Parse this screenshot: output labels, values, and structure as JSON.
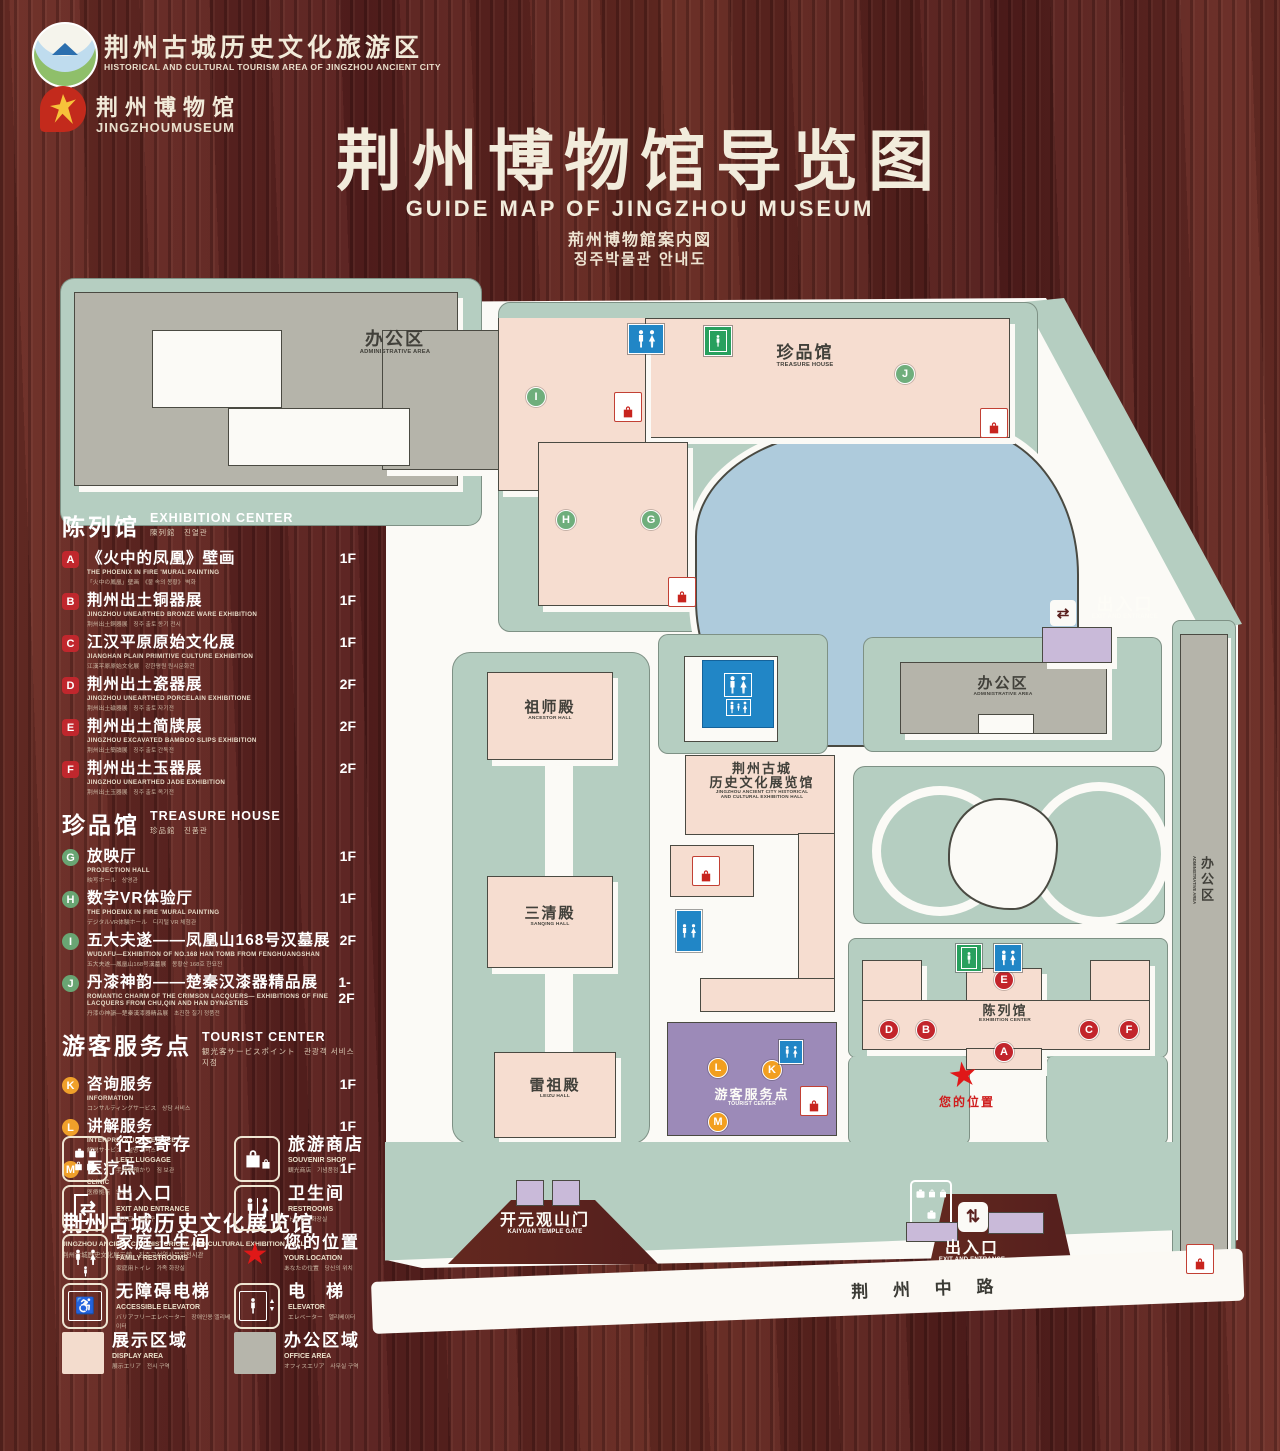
{
  "colors": {
    "wood": "#5a211f",
    "map_green": "#b5cec1",
    "building_pink": "#f6ddd0",
    "building_gray": "#b5b4aa",
    "lake_blue": "#aecbdc",
    "tourist_purple": "#9c8ab8",
    "lavender": "#c9bad9",
    "path_white": "#fbfaf6",
    "marker_red": "#c2242b",
    "marker_green": "#6fae7c",
    "marker_orange": "#f29f1f",
    "restroom_blue": "#2186c6",
    "elevator_green": "#28a05e",
    "star_red": "#e01818"
  },
  "header": {
    "logo1_cn": "荆州古城历史文化旅游区",
    "logo1_en": "HISTORICAL AND CULTURAL TOURISM AREA OF JINGZHOU ANCIENT CITY",
    "logo2_cn": "荆州博物馆",
    "logo2_en": "JINGZHOUMUSEUM",
    "title": "荆州博物馆导览图",
    "subtitle_en": "GUIDE MAP OF JINGZHOU MUSEUM",
    "subtitle_ja": "荊州博物館案内図",
    "subtitle_ko": "징주박물관 안내도"
  },
  "sidebar": {
    "sections": [
      {
        "title_cn": "陈列馆",
        "title_en": "EXHIBITION CENTER",
        "title_sub": "陳列館　진열관",
        "badge": "sq",
        "items": [
          {
            "id": "A",
            "cn": "《火中的凤凰》壁画",
            "en": "THE PHOENIX IN FIRE 'MURAL PAINTING",
            "sub": "「火中の鳳凰」壁画　《불 속의 봉황》 벽화",
            "floor": "1F"
          },
          {
            "id": "B",
            "cn": "荆州出土铜器展",
            "en": "JINGZHOU UNEARTHED BRONZE WARE EXHIBITION",
            "sub": "荆州出土銅器展　징주 출토 동기 전시",
            "floor": "1F"
          },
          {
            "id": "C",
            "cn": "江汉平原原始文化展",
            "en": "JIANGHAN PLAIN PRIMITIVE CULTURE EXHIBITION",
            "sub": "江漢平原原始文化展　강한평원 원시문화전",
            "floor": "1F"
          },
          {
            "id": "D",
            "cn": "荆州出土瓷器展",
            "en": "JINGZHOU UNEARTHED PORCELAIN EXHIBITIONE",
            "sub": "荆州出土磁器展　징주 출토 자기전",
            "floor": "2F"
          },
          {
            "id": "E",
            "cn": "荆州出土简牍展",
            "en": "JINGZHOU EXCAVATED BAMBOO SLIPS EXHIBITION",
            "sub": "荆州出土簡牘展　징주 출토 간독전",
            "floor": "2F"
          },
          {
            "id": "F",
            "cn": "荆州出土玉器展",
            "en": "JINGZHOU UNEARTHED JADE EXHIBITION",
            "sub": "荆州出土玉器展　징주 출토 옥기전",
            "floor": "2F"
          }
        ]
      },
      {
        "title_cn": "珍品馆",
        "title_en": "TREASURE HOUSE",
        "title_sub": "珍品館　진품관",
        "badge": "ci",
        "items": [
          {
            "id": "G",
            "cn": "放映厅",
            "en": "PROJECTION HALL",
            "sub": "映写ホール　상영관",
            "floor": "1F"
          },
          {
            "id": "H",
            "cn": "数字VR体验厅",
            "en": "THE PHOENIX IN FIRE 'MURAL PAINTING",
            "sub": "デジタルVR体験ホール　디지털 VR 체험관",
            "floor": "1F"
          },
          {
            "id": "I",
            "cn": "五大夫遂——凤凰山168号汉墓展",
            "en": "WUDAFU—EXHIBITION OF NO.168 HAN TOMB FROM FENGHUANGSHAN",
            "sub": "五大夫遂—鳳凰山168号漢墓展　봉황산 168호 한묘전",
            "floor": "2F"
          },
          {
            "id": "J",
            "cn": "丹漆神韵——楚秦汉漆器精品展",
            "en": "ROMANTIC CHARM OF THE CRIMSON LACQUERS— EXHIBITIONS OF FINE LACQUERS FROM CHU,QIN AND HAN DYNASTIES",
            "sub": "丹漆の神韻—楚秦漢漆器精品展　초진한 칠기 정품전",
            "floor": "1-2F"
          }
        ]
      },
      {
        "title_cn": "游客服务点",
        "title_en": "TOURIST CENTER",
        "title_sub": "観光客サービスポイント　관광객 서비스 지점",
        "badge": "or",
        "items": [
          {
            "id": "K",
            "cn": "咨询服务",
            "en": "INFORMATION",
            "sub": "コンサルティングサービス　상담 서비스",
            "floor": "1F"
          },
          {
            "id": "L",
            "cn": "讲解服务",
            "en": "INTERPRETATION SERVICE",
            "sub": "解説サービス　설명 서비스",
            "floor": "1F"
          },
          {
            "id": "M",
            "cn": "医疗点",
            "en": "CLINIC",
            "sub": "医療拠点　의료점",
            "floor": "1F"
          }
        ]
      }
    ],
    "hall_heading": {
      "cn": "荆州古城历史文化展览馆",
      "en": "JINGZHOU ANCIENT CITY HISTORICAL AND CULTURAL EXHIBITION HALL",
      "sub": "荆州古城歴史文化展示館　징주고성역사문화전시관"
    }
  },
  "legend": {
    "items": [
      {
        "icon": "luggage",
        "cn": "行李寄存",
        "en": "LEFT LUGGAGE",
        "sub": "手荷物預かり　짐 보관"
      },
      {
        "icon": "souvenir",
        "cn": "旅游商店",
        "en": "SOUVENIR SHOP",
        "sub": "観光商店　기념품점"
      },
      {
        "icon": "exit",
        "cn": "出入口",
        "en": "EXIT AND ENTRANCE",
        "sub": "出入口　출입구"
      },
      {
        "icon": "restroom",
        "cn": "卫生间",
        "en": "RESTROOMS",
        "sub": "トイレ　화장실"
      },
      {
        "icon": "family",
        "cn": "家庭卫生间",
        "en": "FAMILY RESTROOMS",
        "sub": "家庭用トイレ　가족 화장실"
      },
      {
        "icon": "star",
        "cn": "您的位置",
        "en": "YOUR LOCATION",
        "sub": "あなたの位置　당신의 위치"
      },
      {
        "icon": "wheelchair",
        "cn": "无障碍电梯",
        "en": "ACCESSIBLE ELEVATOR",
        "sub": "バリアフリーエレベーター　장애인용 엘리베이터"
      },
      {
        "icon": "elevator",
        "cn": "电　梯",
        "en": "ELEVATOR",
        "sub": "エレベーター　엘리베이터"
      },
      {
        "icon": "swatch-pink",
        "cn": "展示区域",
        "en": "DISPLAY AREA",
        "sub": "展示エリア　전시 구역"
      },
      {
        "icon": "swatch-gray",
        "cn": "办公区域",
        "en": "OFFICE AREA",
        "sub": "オフィスエリア　사무실 구역"
      }
    ]
  },
  "map": {
    "labels": {
      "admin_nw": {
        "cn": "办公区",
        "en": "ADMINISTRATIVE AREA"
      },
      "treasure": {
        "cn": "珍品馆",
        "en": "TREASURE HOUSE"
      },
      "ancestor": {
        "cn": "祖师殿",
        "en": "ANCESTOR HALL"
      },
      "sanqing": {
        "cn": "三清殿",
        "en": "SANQING HALL"
      },
      "leizu": {
        "cn": "雷祖殿",
        "en": "LEIZU HALL"
      },
      "exhibition_hall": {
        "cn1": "荆州古城",
        "cn2": "历史文化展览馆",
        "en1": "JINGZHOU ANCIENT CITY HISTORICAL",
        "en2": "AND CULTURAL EXHIBITION HALL"
      },
      "tourist": {
        "cn": "游客服务点",
        "en": "TOURIST CENTER"
      },
      "exhibition_center": {
        "cn": "陈列馆",
        "en": "EXHIBITION CENTER"
      },
      "exit_top": {
        "cn": "出入口",
        "en": "EXIT AND ENTRANCE"
      },
      "exit_bottom": {
        "cn": "出入口",
        "en": "EXIT AND ENTRANCE"
      },
      "gate": {
        "cn": "开元观山门",
        "en": "KAIYUAN TEMPLE GATE"
      },
      "admin_east": {
        "cn": "办公区",
        "en": "ADMINISTRATIVE AREA"
      },
      "admin_strip": {
        "cn": "办公区",
        "en": "ADMINISTRATIVE AREA"
      },
      "road": {
        "cn": "荆 州 中 路"
      },
      "your_location": {
        "cn": "您的位置"
      }
    },
    "markers": [
      {
        "letter": "I",
        "color": "g",
        "x": 536,
        "y": 397
      },
      {
        "letter": "J",
        "color": "g",
        "x": 905,
        "y": 374
      },
      {
        "letter": "H",
        "color": "g",
        "x": 566,
        "y": 520
      },
      {
        "letter": "G",
        "color": "g",
        "x": 651,
        "y": 520
      },
      {
        "letter": "E",
        "color": "r",
        "x": 1004,
        "y": 980
      },
      {
        "letter": "D",
        "color": "r",
        "x": 889,
        "y": 1030
      },
      {
        "letter": "B",
        "color": "r",
        "x": 926,
        "y": 1030
      },
      {
        "letter": "C",
        "color": "r",
        "x": 1089,
        "y": 1030
      },
      {
        "letter": "F",
        "color": "r",
        "x": 1129,
        "y": 1030
      },
      {
        "letter": "A",
        "color": "r",
        "x": 1004,
        "y": 1052
      },
      {
        "letter": "L",
        "color": "o",
        "x": 718,
        "y": 1068
      },
      {
        "letter": "K",
        "color": "o",
        "x": 772,
        "y": 1070
      },
      {
        "letter": "M",
        "color": "o",
        "x": 718,
        "y": 1122
      }
    ],
    "shop_icons": [
      [
        614,
        392
      ],
      [
        980,
        408
      ],
      [
        668,
        577
      ],
      [
        692,
        856
      ],
      [
        800,
        1086
      ],
      [
        1186,
        1244
      ]
    ],
    "wc_icons": [
      [
        628,
        324,
        34,
        28
      ],
      [
        676,
        910,
        24,
        40
      ],
      [
        779,
        1040,
        22,
        22
      ],
      [
        994,
        944,
        26,
        26
      ]
    ],
    "elevator_icons": [
      [
        704,
        326,
        26,
        28
      ],
      [
        956,
        944,
        24,
        26
      ]
    ]
  }
}
